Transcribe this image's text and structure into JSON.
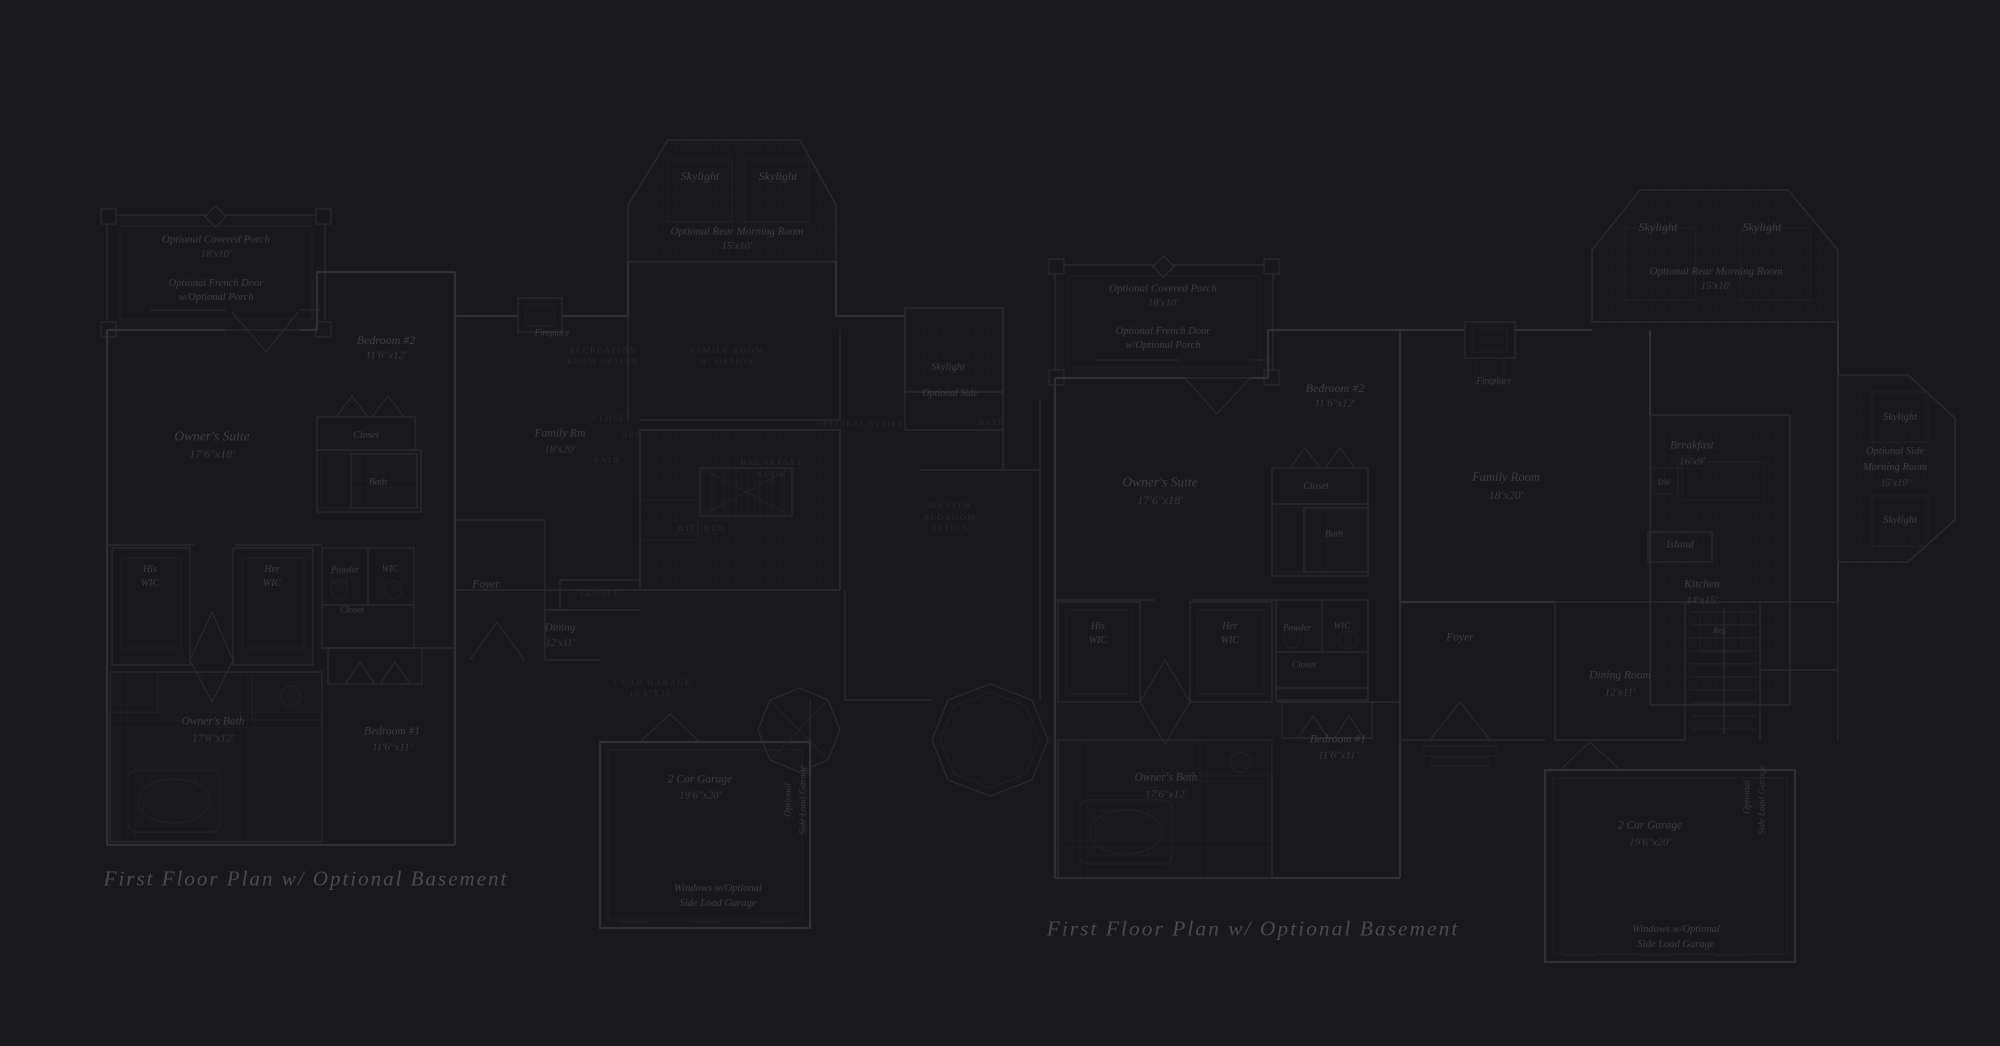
{
  "page": {
    "background": "#19181a",
    "description": "Two dark blueprint first-floor plans"
  },
  "palette": {
    "background": "#19181a",
    "wall": "#312f34",
    "wall_minor": "#2a292d",
    "fine": "#242327",
    "grid": "#202024",
    "label": "#3e3c45",
    "label_dim": "#393741",
    "caps": "#2b2a2f",
    "title": "#4b4852"
  },
  "plans": [
    {
      "name": "left-first-floor-plan",
      "title": "First Floor Plan  w/ Optional Basement",
      "title_pos": {
        "x": 306,
        "y": 879,
        "s": 21
      },
      "labels": [
        {
          "t": "Optional Covered Porch",
          "x": 216,
          "y": 240,
          "s": 11,
          "st": "it"
        },
        {
          "t": "18'x10'",
          "x": 216,
          "y": 255,
          "s": 10.5,
          "st": "dim"
        },
        {
          "t": "Optional French Door",
          "x": 216,
          "y": 284,
          "s": 10.5,
          "st": "it"
        },
        {
          "t": "w/Optional Porch",
          "x": 216,
          "y": 298,
          "s": 10.5,
          "st": "it"
        },
        {
          "t": "Owner's Suite",
          "x": 212,
          "y": 436,
          "s": 13.5,
          "st": "it"
        },
        {
          "t": "17'6\"x18'",
          "x": 212,
          "y": 454,
          "s": 12,
          "st": "dim"
        },
        {
          "t": "Bedroom #2",
          "x": 386,
          "y": 340,
          "s": 12,
          "st": "it"
        },
        {
          "t": "11'6\"x12'",
          "x": 386,
          "y": 356,
          "s": 11,
          "st": "dim"
        },
        {
          "t": "Closet",
          "x": 366,
          "y": 436,
          "s": 10,
          "st": "it"
        },
        {
          "t": "Bath",
          "x": 378,
          "y": 483,
          "s": 9.5,
          "st": "it"
        },
        {
          "t": "His",
          "x": 150,
          "y": 570,
          "s": 10,
          "st": "it"
        },
        {
          "t": "WIC",
          "x": 150,
          "y": 584,
          "s": 10,
          "st": "it"
        },
        {
          "t": "Her",
          "x": 272,
          "y": 570,
          "s": 10,
          "st": "it"
        },
        {
          "t": "WIC",
          "x": 272,
          "y": 584,
          "s": 10,
          "st": "it"
        },
        {
          "t": "Powder",
          "x": 345,
          "y": 570,
          "s": 9,
          "st": "it"
        },
        {
          "t": "WIC",
          "x": 390,
          "y": 569,
          "s": 9,
          "st": "it"
        },
        {
          "t": "Closet",
          "x": 352,
          "y": 611,
          "s": 9.5,
          "st": "it"
        },
        {
          "t": "Owner's Bath",
          "x": 213,
          "y": 722,
          "s": 11.5,
          "st": "it"
        },
        {
          "t": "17'6\"x12'",
          "x": 213,
          "y": 739,
          "s": 11,
          "st": "dim"
        },
        {
          "t": "Bedroom #1",
          "x": 392,
          "y": 732,
          "s": 11.5,
          "st": "it"
        },
        {
          "t": "11'6\"x11'",
          "x": 392,
          "y": 748,
          "s": 11,
          "st": "dim"
        },
        {
          "t": "Skylight",
          "x": 700,
          "y": 176,
          "s": 12,
          "st": "it"
        },
        {
          "t": "Skylight",
          "x": 778,
          "y": 176,
          "s": 12,
          "st": "it"
        },
        {
          "t": "Optional Rear Morning Room",
          "x": 737,
          "y": 232,
          "s": 11,
          "st": "it"
        },
        {
          "t": "15'x10'",
          "x": 737,
          "y": 247,
          "s": 10.5,
          "st": "dim"
        },
        {
          "t": "Fireplace",
          "x": 552,
          "y": 333,
          "s": 9,
          "st": "it"
        },
        {
          "t": "Family Rm",
          "x": 560,
          "y": 434,
          "s": 11.5,
          "st": "it"
        },
        {
          "t": "18'x20'",
          "x": 560,
          "y": 450,
          "s": 11,
          "st": "dim"
        },
        {
          "t": "Foyer",
          "x": 486,
          "y": 585,
          "s": 11.5,
          "st": "it"
        },
        {
          "t": "Dining",
          "x": 560,
          "y": 628,
          "s": 11,
          "st": "it"
        },
        {
          "t": "12'x11'",
          "x": 560,
          "y": 644,
          "s": 10.5,
          "st": "dim"
        },
        {
          "t": "Skylight",
          "x": 948,
          "y": 368,
          "s": 10.5,
          "st": "it"
        },
        {
          "t": "Optional Side",
          "x": 950,
          "y": 394,
          "s": 10,
          "st": "it"
        },
        {
          "t": "2 Car Garage",
          "x": 700,
          "y": 780,
          "s": 11.5,
          "st": "it"
        },
        {
          "t": "19'6\"x20'",
          "x": 700,
          "y": 796,
          "s": 11,
          "st": "dim"
        },
        {
          "t": "Optional",
          "x": 789,
          "y": 800,
          "s": 9.5,
          "st": "vert"
        },
        {
          "t": "Side Load Garage",
          "x": 804,
          "y": 800,
          "s": 9.5,
          "st": "vert"
        },
        {
          "t": "Windows w/Optional",
          "x": 718,
          "y": 889,
          "s": 10.5,
          "st": "it"
        },
        {
          "t": "Side Load Garage",
          "x": 718,
          "y": 904,
          "s": 10.5,
          "st": "it"
        },
        {
          "t": "RECREATION",
          "x": 603,
          "y": 350,
          "s": 8.5,
          "st": "caps"
        },
        {
          "t": "ROOM OPTION",
          "x": 603,
          "y": 362,
          "s": 8,
          "st": "caps"
        },
        {
          "t": "FAMILY ROOM",
          "x": 727,
          "y": 350,
          "s": 8.5,
          "st": "caps"
        },
        {
          "t": "W/ OPTION",
          "x": 727,
          "y": 362,
          "s": 8,
          "st": "caps"
        },
        {
          "t": "CLOSET",
          "x": 612,
          "y": 419,
          "s": 8,
          "st": "caps"
        },
        {
          "t": "DEN",
          "x": 632,
          "y": 436,
          "s": 8,
          "st": "caps"
        },
        {
          "t": "BATH",
          "x": 607,
          "y": 461,
          "s": 8,
          "st": "caps"
        },
        {
          "t": "BREAKFAST",
          "x": 772,
          "y": 462,
          "s": 8.5,
          "st": "caps"
        },
        {
          "t": "NOOK",
          "x": 772,
          "y": 474,
          "s": 8.5,
          "st": "caps"
        },
        {
          "t": "KITCHEN",
          "x": 702,
          "y": 528,
          "s": 8.5,
          "st": "caps"
        },
        {
          "t": "BATH",
          "x": 992,
          "y": 423,
          "s": 8,
          "st": "caps"
        },
        {
          "t": "MASTER",
          "x": 950,
          "y": 505,
          "s": 8.5,
          "st": "caps"
        },
        {
          "t": "BEDROOM",
          "x": 950,
          "y": 517,
          "s": 8.5,
          "st": "caps"
        },
        {
          "t": "OPTION",
          "x": 950,
          "y": 529,
          "s": 8,
          "st": "caps"
        },
        {
          "t": "OPTIONAL STAIRS",
          "x": 860,
          "y": 424,
          "s": 7.5,
          "st": "caps"
        },
        {
          "t": "CLOSET",
          "x": 600,
          "y": 594,
          "s": 8,
          "st": "caps"
        },
        {
          "t": "2 CAR GARAGE",
          "x": 652,
          "y": 682,
          "s": 8.5,
          "st": "caps"
        },
        {
          "t": "19'6\"X20'",
          "x": 652,
          "y": 694,
          "s": 8,
          "st": "caps"
        }
      ]
    },
    {
      "name": "right-first-floor-plan",
      "title": "First Floor Plan  w/ Optional Basement",
      "title_pos": {
        "x": 1253,
        "y": 929,
        "s": 21.5
      },
      "labels": [
        {
          "t": "Optional Covered Porch",
          "x": 1163,
          "y": 289,
          "s": 11,
          "st": "it"
        },
        {
          "t": "18'x10'",
          "x": 1163,
          "y": 304,
          "s": 10.5,
          "st": "dim"
        },
        {
          "t": "Optional French Door",
          "x": 1163,
          "y": 332,
          "s": 10.5,
          "st": "it"
        },
        {
          "t": "w/Optional Porch",
          "x": 1163,
          "y": 346,
          "s": 10.5,
          "st": "it"
        },
        {
          "t": "Owner's Suite",
          "x": 1160,
          "y": 482,
          "s": 13.5,
          "st": "it"
        },
        {
          "t": "17'6\"x18'",
          "x": 1160,
          "y": 500,
          "s": 12,
          "st": "dim"
        },
        {
          "t": "Bedroom #2",
          "x": 1335,
          "y": 388,
          "s": 12,
          "st": "it"
        },
        {
          "t": "11'6\"x12'",
          "x": 1335,
          "y": 404,
          "s": 11,
          "st": "dim"
        },
        {
          "t": "Closet",
          "x": 1316,
          "y": 487,
          "s": 10,
          "st": "it"
        },
        {
          "t": "Bath",
          "x": 1334,
          "y": 535,
          "s": 9.5,
          "st": "it"
        },
        {
          "t": "His",
          "x": 1098,
          "y": 627,
          "s": 10,
          "st": "it"
        },
        {
          "t": "WIC",
          "x": 1098,
          "y": 641,
          "s": 10,
          "st": "it"
        },
        {
          "t": "Her",
          "x": 1230,
          "y": 627,
          "s": 10,
          "st": "it"
        },
        {
          "t": "WIC",
          "x": 1230,
          "y": 641,
          "s": 10,
          "st": "it"
        },
        {
          "t": "Powder",
          "x": 1297,
          "y": 628,
          "s": 9,
          "st": "it"
        },
        {
          "t": "WIC",
          "x": 1342,
          "y": 626,
          "s": 9,
          "st": "it"
        },
        {
          "t": "Closet",
          "x": 1304,
          "y": 666,
          "s": 9.5,
          "st": "it"
        },
        {
          "t": "Owner's Bath",
          "x": 1166,
          "y": 778,
          "s": 11.5,
          "st": "it"
        },
        {
          "t": "17'6\"x12'",
          "x": 1166,
          "y": 795,
          "s": 11,
          "st": "dim"
        },
        {
          "t": "Bedroom #1",
          "x": 1338,
          "y": 740,
          "s": 11.5,
          "st": "it"
        },
        {
          "t": "11'6\"x11'",
          "x": 1338,
          "y": 756,
          "s": 11,
          "st": "dim"
        },
        {
          "t": "Skylight",
          "x": 1658,
          "y": 227,
          "s": 12,
          "st": "it"
        },
        {
          "t": "Skylight",
          "x": 1762,
          "y": 227,
          "s": 12,
          "st": "it"
        },
        {
          "t": "Optional Rear Morning Room",
          "x": 1716,
          "y": 272,
          "s": 11,
          "st": "it"
        },
        {
          "t": "15'x10'",
          "x": 1716,
          "y": 287,
          "s": 10.5,
          "st": "dim"
        },
        {
          "t": "Fireplace",
          "x": 1494,
          "y": 381,
          "s": 9,
          "st": "it"
        },
        {
          "t": "Family Room",
          "x": 1506,
          "y": 477,
          "s": 12.5,
          "st": "it"
        },
        {
          "t": "18'x20'",
          "x": 1506,
          "y": 495,
          "s": 12,
          "st": "dim"
        },
        {
          "t": "Breakfast",
          "x": 1692,
          "y": 446,
          "s": 11.5,
          "st": "it"
        },
        {
          "t": "16'x9'",
          "x": 1692,
          "y": 462,
          "s": 11,
          "st": "dim"
        },
        {
          "t": "DW",
          "x": 1664,
          "y": 483,
          "s": 8,
          "st": "it"
        },
        {
          "t": "Island",
          "x": 1680,
          "y": 545,
          "s": 11,
          "st": "it"
        },
        {
          "t": "Kitchen",
          "x": 1702,
          "y": 585,
          "s": 11.5,
          "st": "it"
        },
        {
          "t": "14'x15'",
          "x": 1702,
          "y": 601,
          "s": 11,
          "st": "dim"
        },
        {
          "t": "Ref.",
          "x": 1720,
          "y": 630,
          "s": 8.5,
          "st": "it"
        },
        {
          "t": "Skylight",
          "x": 1900,
          "y": 418,
          "s": 10.5,
          "st": "it"
        },
        {
          "t": "Optional Side",
          "x": 1895,
          "y": 452,
          "s": 10.5,
          "st": "it"
        },
        {
          "t": "Morning Room",
          "x": 1895,
          "y": 468,
          "s": 10.5,
          "st": "it"
        },
        {
          "t": "15'x10'",
          "x": 1895,
          "y": 484,
          "s": 10,
          "st": "dim"
        },
        {
          "t": "Skylight",
          "x": 1900,
          "y": 521,
          "s": 10.5,
          "st": "it"
        },
        {
          "t": "Foyer",
          "x": 1460,
          "y": 638,
          "s": 11.5,
          "st": "it"
        },
        {
          "t": "Dining Room",
          "x": 1620,
          "y": 676,
          "s": 11.5,
          "st": "it"
        },
        {
          "t": "12'x11'",
          "x": 1620,
          "y": 693,
          "s": 11,
          "st": "dim"
        },
        {
          "t": "2 Car Garage",
          "x": 1650,
          "y": 826,
          "s": 11.5,
          "st": "it"
        },
        {
          "t": "19'6\"x20'",
          "x": 1650,
          "y": 843,
          "s": 11,
          "st": "dim"
        },
        {
          "t": "Optional",
          "x": 1748,
          "y": 797,
          "s": 9.5,
          "st": "vert"
        },
        {
          "t": "Side Load Garage",
          "x": 1763,
          "y": 800,
          "s": 9.5,
          "st": "vert"
        },
        {
          "t": "Windows w/Optional",
          "x": 1676,
          "y": 930,
          "s": 10.5,
          "st": "it"
        },
        {
          "t": "Side Load Garage",
          "x": 1676,
          "y": 945,
          "s": 10.5,
          "st": "it"
        }
      ]
    }
  ]
}
